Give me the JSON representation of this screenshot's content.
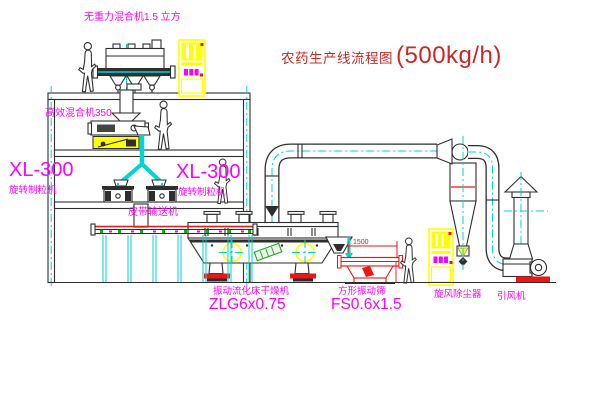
{
  "title": {
    "text_cn": "农药生产线流程图",
    "capacity": "(500kg/h)"
  },
  "labels": {
    "top_mixer": "无重力混合机1.5 立方",
    "mid_mixer": "高效混合机350",
    "granulator_left": {
      "model": "XL-300",
      "name": "旋转制粒机"
    },
    "granulator_right": {
      "model": "XL-300",
      "name": "旋转制粒机"
    },
    "belt_conveyor": "皮带输送机",
    "dryer": {
      "name": "振动流化床干燥机",
      "model": "ZLG6x0.75"
    },
    "screen": {
      "name": "方形振动筛",
      "model": "FS0.6x1.5"
    },
    "cyclone": "旋风除尘器",
    "fan": "引风机"
  },
  "dimensions": {
    "screen_length": "1500"
  },
  "colors": {
    "centerline_cyan": "#00d4d4",
    "label_magenta": "#ff00ff",
    "title_red": "#cc2626",
    "dimension_red": "#ee1515",
    "cabinet_yellow": "#ffff00",
    "motor_green": "#1fa41f",
    "line_dark": "#2e2e2e",
    "background": "#ffffff"
  }
}
